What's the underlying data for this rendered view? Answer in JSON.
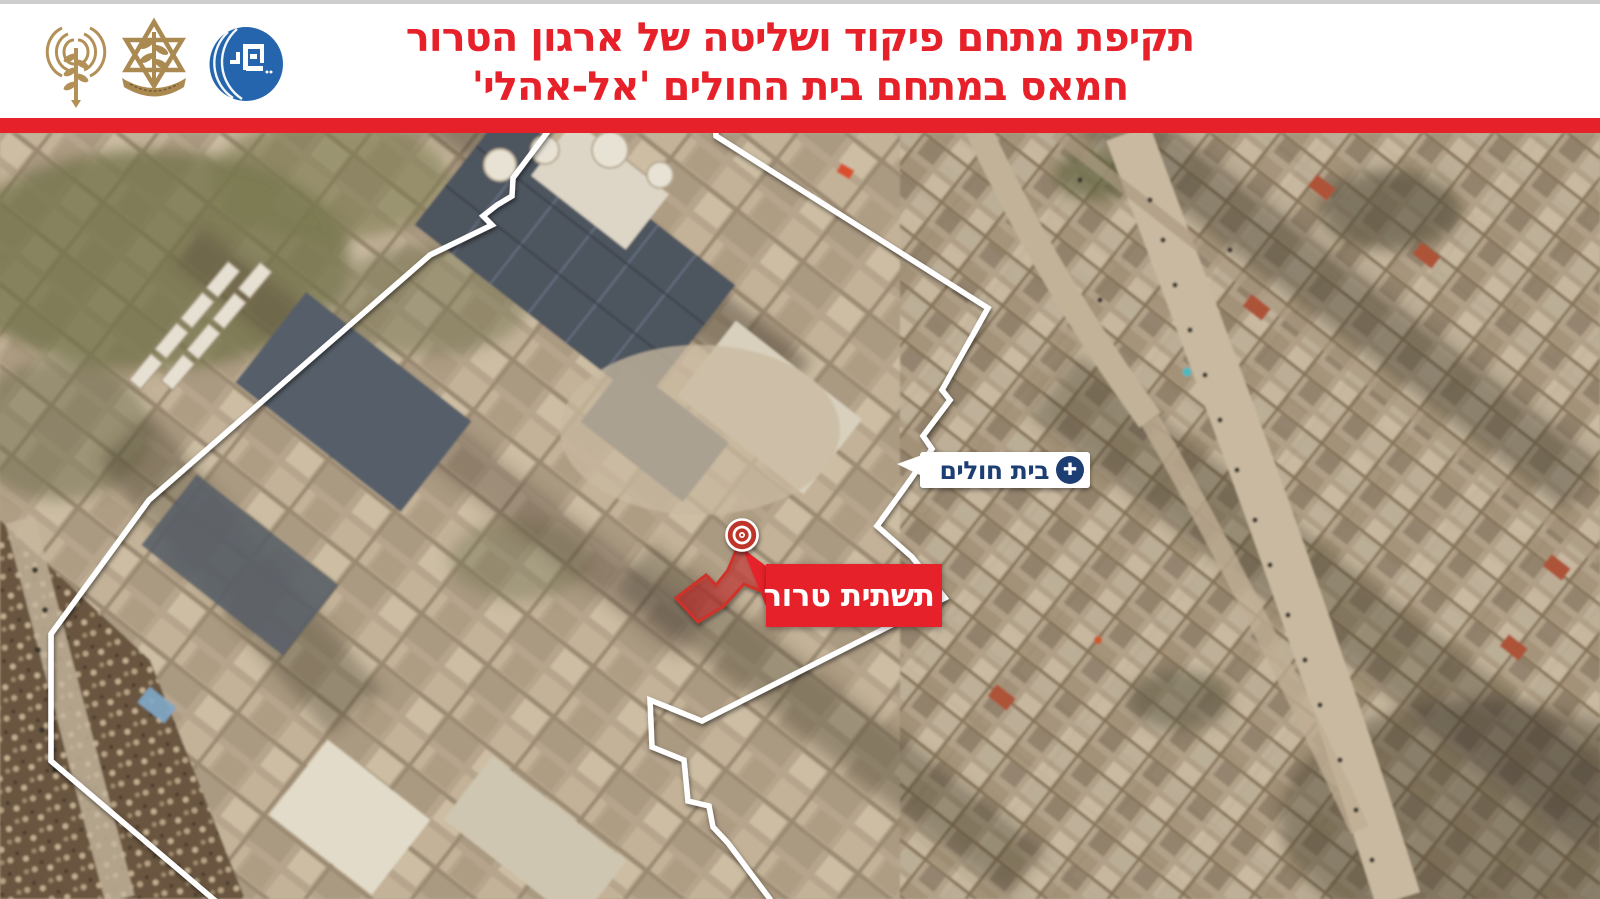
{
  "header": {
    "title_line1": "תקיפת מתחם פיקוד ושליטה של ארגון הטרור",
    "title_line2": "חמאס במתחם בית החולים 'אל-אהלי'",
    "title_color": "#e7212a",
    "divider_color": "#e7212a",
    "logos": [
      {
        "name": "idf-spokesperson-antenna-logo",
        "color": "#b29058"
      },
      {
        "name": "idf-emblem-logo",
        "color": "#b29058"
      },
      {
        "name": "round-blue-unit-logo",
        "color": "#2565ad"
      }
    ]
  },
  "map": {
    "compound_outline_color": "#ffffff",
    "hospital_label": {
      "text": "בית חולים",
      "text_color": "#1d3e72",
      "background": "#ffffff",
      "icon": "medical-cross-icon",
      "icon_glyph": "✚"
    },
    "terror_label": {
      "text": "תשתית טרור",
      "text_color": "#ffffff",
      "background": "#e7212a"
    },
    "target_marker": {
      "color": "#bf352a",
      "ring_color": "#ffffff"
    }
  }
}
